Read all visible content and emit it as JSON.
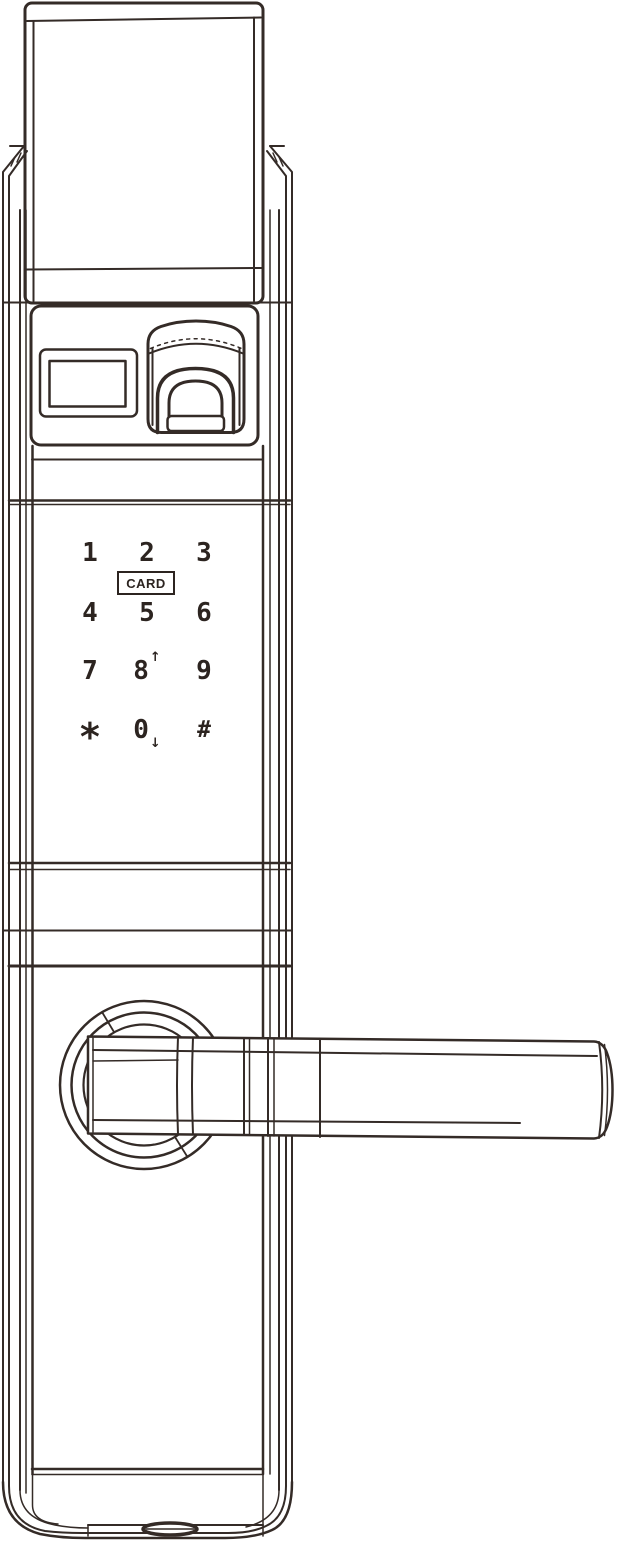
{
  "figure": {
    "type": "door-lock-front-view-line-drawing",
    "line_color": "#342b27",
    "background_color": "#ffffff"
  },
  "keypad": {
    "card_label": "CARD",
    "keys": [
      {
        "label": "1"
      },
      {
        "label": "2"
      },
      {
        "label": "3"
      },
      {
        "label": "4"
      },
      {
        "label": "5"
      },
      {
        "label": "6"
      },
      {
        "label": "7"
      },
      {
        "label": "8",
        "arrow": "↑"
      },
      {
        "label": "9"
      },
      {
        "label": "*"
      },
      {
        "label": "0",
        "arrow": "↓"
      },
      {
        "label": "#"
      }
    ]
  }
}
